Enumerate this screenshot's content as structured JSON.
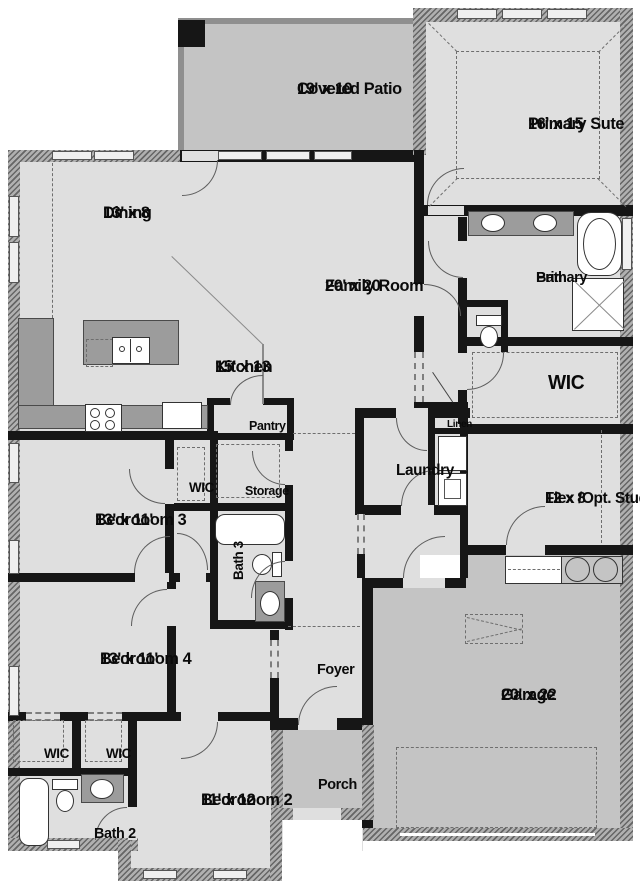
{
  "rooms": {
    "covered_patio": {
      "name": "Covered Patio",
      "dims": "19' x 10"
    },
    "primary_suite": {
      "name": "Primary Sute",
      "dims": "16' x 15"
    },
    "dining": {
      "name": "Dining",
      "dims": "13' x 8"
    },
    "family_room": {
      "name": "Family Room",
      "dims": "20' x 20"
    },
    "kitchen": {
      "name": "Kitchen",
      "dims": "15' x 13"
    },
    "primary_bath": {
      "line1": "Primary",
      "line2": "Bath"
    },
    "primary_wic": {
      "name": "WIC"
    },
    "linen": {
      "name": "Linen"
    },
    "laundry": {
      "name": "Laundry"
    },
    "flex_study": {
      "name": "Flex /Opt. Study",
      "dims": "12 x 8"
    },
    "bedroom3": {
      "name": "Bedrooom 3",
      "dims": "13' x 11'"
    },
    "wic_bed3": {
      "name": "WIC"
    },
    "storage": {
      "name": "Storage"
    },
    "bath3": {
      "name": "Bath 3"
    },
    "pantry": {
      "name": "Pantry"
    },
    "bedroom4": {
      "name": "Bedrooom 4",
      "dims": "13' x 11'"
    },
    "wic_left": {
      "name": "WIC"
    },
    "wic_right": {
      "name": "WIC"
    },
    "bath2": {
      "name": "Bath 2"
    },
    "bedroom2": {
      "name": "Bedrooom 2",
      "dims": "11' x 12"
    },
    "foyer": {
      "name": "Foyer"
    },
    "porch": {
      "name": "Porch"
    },
    "garage": {
      "name": "Garage",
      "dims": "20' x 22"
    }
  },
  "fixtures": [
    "kitchen-island-sink",
    "cooktop",
    "refrigerator",
    "double-vanity-sinks",
    "primary-bathtub",
    "shower",
    "toilet",
    "washer-dryer",
    "bathtub",
    "vanity-sink",
    "water-heater",
    "garage-steps",
    "attic-access",
    "garage-door",
    "tray-ceiling",
    "closet-rods"
  ],
  "colors": {
    "floor": "#dfdfdf",
    "outdoor": "#c4c4c4",
    "counter": "#9c9c9c",
    "wall": "#161616"
  }
}
